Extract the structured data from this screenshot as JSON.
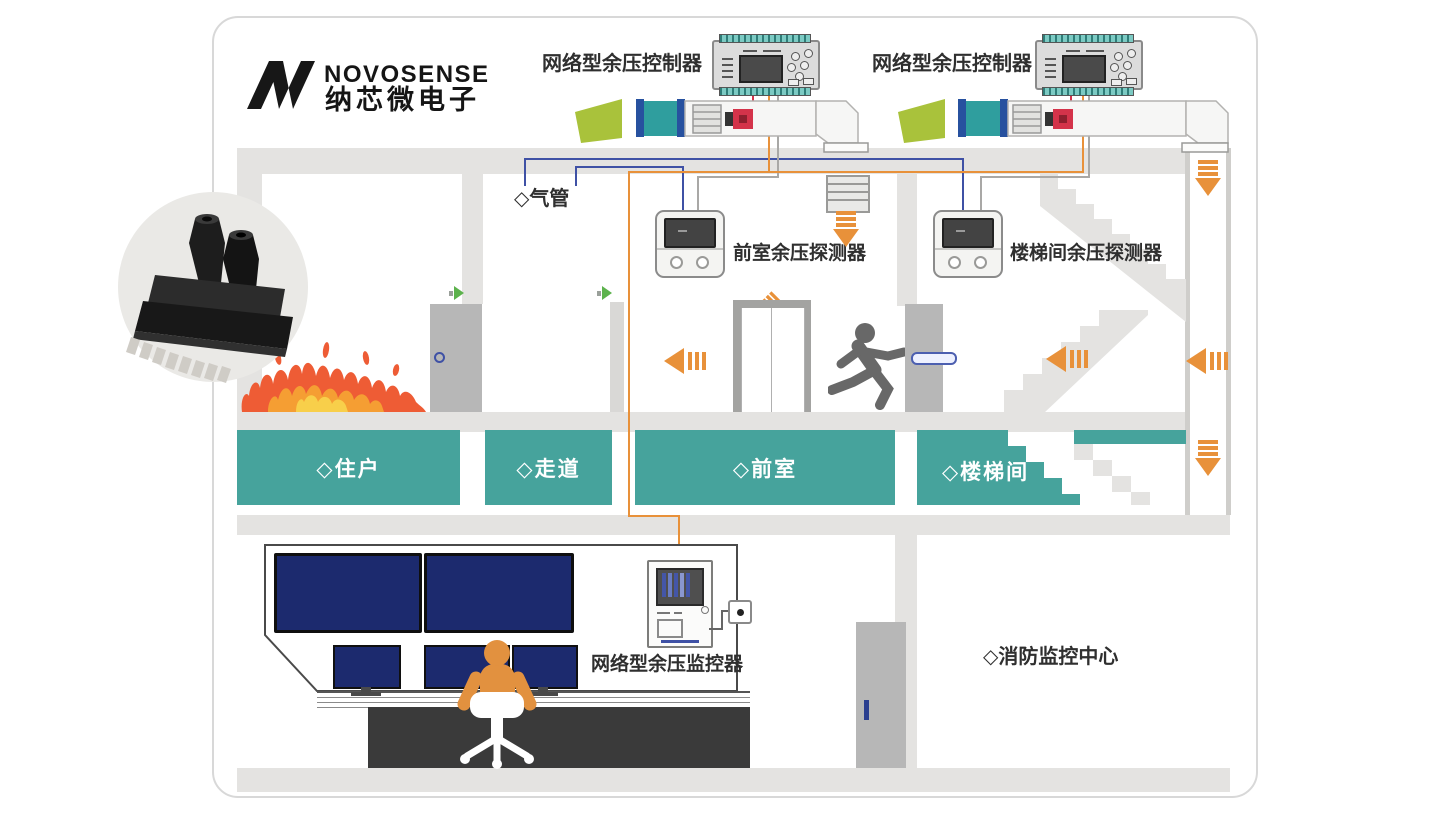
{
  "brand": {
    "logo_text": "NOVOSENSE",
    "logo_cn": "纳芯微电子"
  },
  "controllers": {
    "left_label": "网络型余压控制器",
    "right_label": "网络型余压控制器"
  },
  "detectors": {
    "air_tube_label": "◇气管",
    "front_room_label": "前室余压探测器",
    "stairwell_label": "楼梯间余压探测器"
  },
  "rooms": [
    {
      "label": "◇住户"
    },
    {
      "label": "◇走道"
    },
    {
      "label": "◇前室"
    },
    {
      "label": "◇楼梯间"
    }
  ],
  "control_center": {
    "monitor_label": "网络型余压监控器",
    "room_label": "◇消防监控中心"
  },
  "colors": {
    "teal": "#46a39c",
    "wall_gray": "#e4e3e1",
    "airflow_orange": "#e8913a",
    "tube_blue": "#3f51a5",
    "alarm_red": "#d4334a",
    "fan_green": "#a9c23b",
    "screen_navy": "#1c2a6e",
    "person_orange": "#e2913f"
  }
}
